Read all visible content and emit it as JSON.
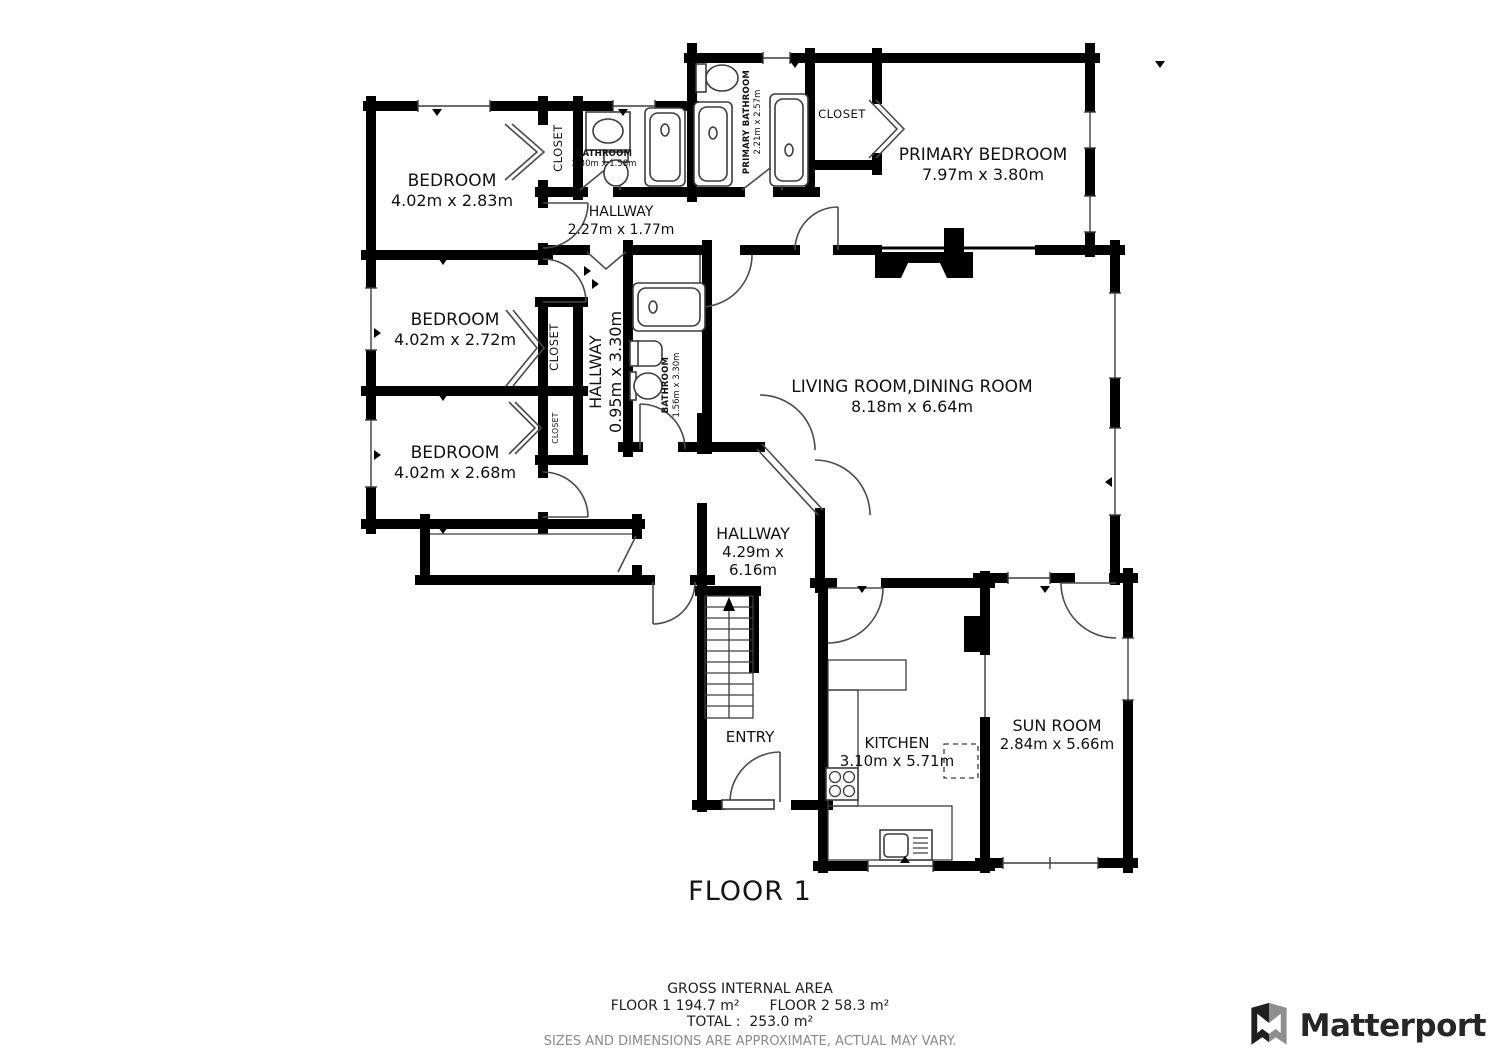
{
  "floor": {
    "title": "FLOOR 1"
  },
  "rooms": {
    "bedroom1": {
      "name": "BEDROOM",
      "dims": "4.02m x 2.83m"
    },
    "bedroom2": {
      "name": "BEDROOM",
      "dims": "4.02m x 2.72m"
    },
    "bedroom3": {
      "name": "BEDROOM",
      "dims": "4.02m x 2.68m"
    },
    "primary_bedroom": {
      "name": "PRIMARY BEDROOM",
      "dims": "7.97m x 3.80m"
    },
    "living_dining": {
      "name": "LIVING ROOM,DINING ROOM",
      "dims": "8.18m x 6.64m"
    },
    "hallway_top": {
      "name": "HALLWAY",
      "dims": "2.27m x 1.77m"
    },
    "hallway_mid": {
      "name": "HALLWAY",
      "dims": "0.95m x 3.30m"
    },
    "hallway_main": {
      "name": "HALLWAY",
      "dims_line1": "4.29m x",
      "dims_line2": "6.16m"
    },
    "kitchen": {
      "name": "KITCHEN",
      "dims": "3.10m x 5.71m"
    },
    "sun_room": {
      "name": "SUN ROOM",
      "dims": "2.84m x 5.66m"
    },
    "entry": {
      "name": "ENTRY"
    },
    "bathroom_top": {
      "name": "BATHROOM",
      "dims": "2.30m x 1.58m"
    },
    "bathroom_mid": {
      "name": "BATHROOM",
      "dims": "1.56m x 3.30m"
    },
    "primary_bathroom": {
      "name": "PRIMARY BATHROOM",
      "dims": "2.21m x 2.57m"
    },
    "closet_bedroom1": {
      "name": "CLOSET"
    },
    "closet_bedroom2": {
      "name": "CLOSET"
    },
    "closet_bedroom3": {
      "name": "CLOSET"
    },
    "closet_primary": {
      "name": "CLOSET"
    }
  },
  "footer": {
    "area_title": "GROSS INTERNAL AREA",
    "floor1_area": "FLOOR 1 194.7 m²",
    "floor2_area": "FLOOR 2 58.3 m²",
    "total": "TOTAL :  253.0 m²",
    "disclaimer": "SIZES AND DIMENSIONS ARE APPROXIMATE, ACTUAL MAY VARY."
  },
  "branding": {
    "logo_text": "Matterport"
  },
  "colors": {
    "wall": "#000000",
    "fixture_stroke": "#3d3d3d",
    "label": "#111111",
    "disclaimer": "#8a8a8a",
    "logo": "#262626"
  }
}
